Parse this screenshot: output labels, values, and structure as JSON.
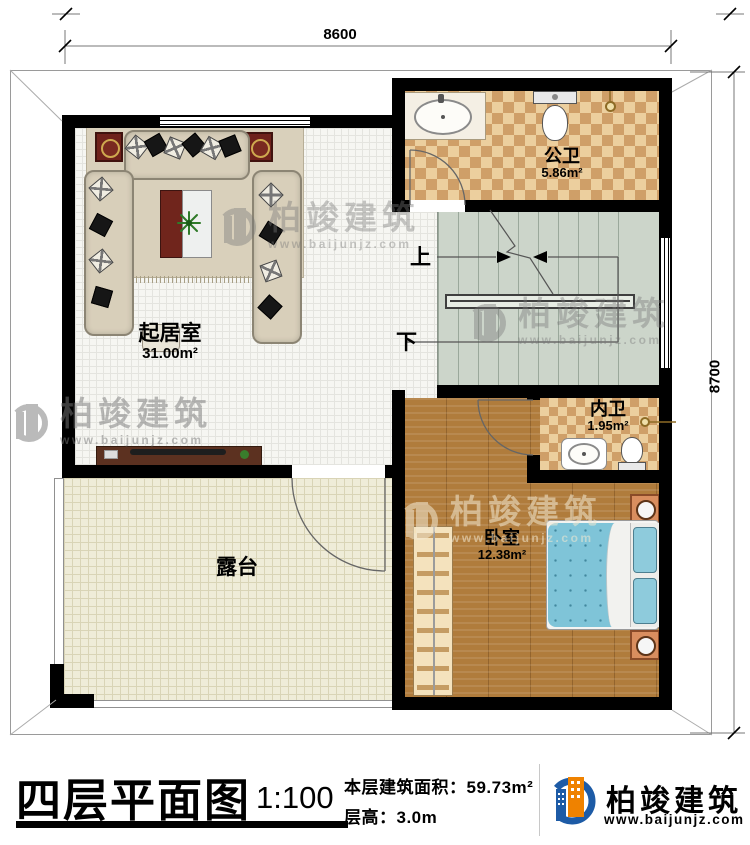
{
  "dimensions": {
    "top": "8600",
    "right": "8700"
  },
  "rooms": {
    "living": {
      "name": "起居室",
      "area": "31.00m²"
    },
    "public_bath": {
      "name": "公卫",
      "area": "5.86m²"
    },
    "inner_bath": {
      "name": "内卫",
      "area": "1.95m²"
    },
    "bedroom": {
      "name": "卧室",
      "area": "12.38m²"
    },
    "terrace": {
      "name": "露台"
    }
  },
  "stairs": {
    "up": "上",
    "down": "下"
  },
  "title_block": {
    "title": "四层平面图",
    "scale": "1:100",
    "floor_area": "本层建筑面积：59.73m²",
    "floor_height": "层高：3.0m"
  },
  "branding": {
    "company": "柏竣建筑",
    "website": "www.baijunjz.com"
  },
  "watermark": {
    "company": "柏竣建筑",
    "website": "www.baijunjz.com"
  },
  "colors": {
    "accent_blue": "#1d5ba6",
    "accent_orange": "#ef8200",
    "wall": "#000000"
  }
}
